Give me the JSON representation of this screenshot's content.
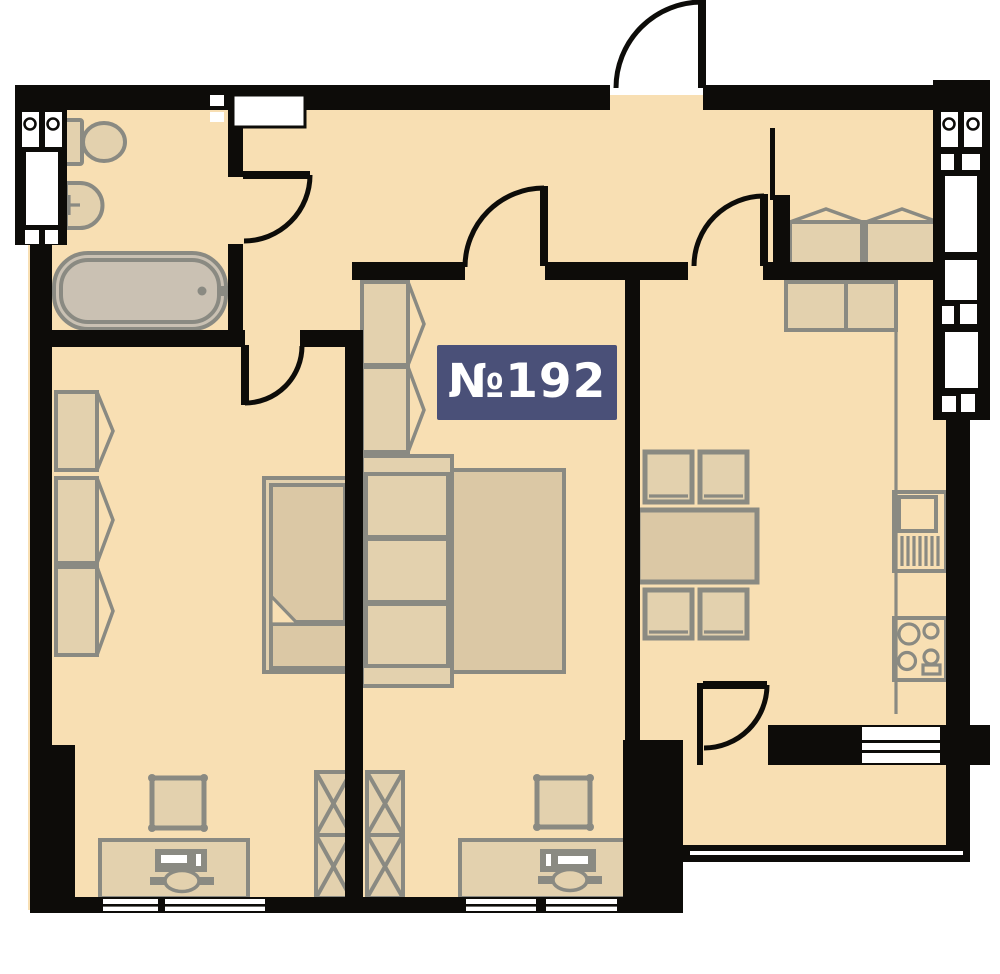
{
  "unit_label": {
    "text": "№192"
  },
  "colors": {
    "bg": "#ffffff",
    "wall": "#0d0c09",
    "floor": "#f8dfb3",
    "furniture": "#e3d1ae",
    "furniture2": "#dbc8a5",
    "fixture": "#cac1b3",
    "stroke": "#8a8a82",
    "window": "#ffffff",
    "label_bg": "#4a5078",
    "label_text": "#ffffff"
  },
  "icons": [
    "entrance-door",
    "bathroom-door",
    "bedroom-door",
    "kitchen-door",
    "left-room-door",
    "balcony-door",
    "toilet",
    "washbasin",
    "bathtub",
    "wardrobe",
    "single-bed",
    "double-bed",
    "shelving-x-unit",
    "desk",
    "computer",
    "chair",
    "dining-table",
    "dining-chair",
    "kitchen-cabinets",
    "kitchen-sink",
    "stove",
    "window",
    "vent-shaft",
    "balcony"
  ]
}
